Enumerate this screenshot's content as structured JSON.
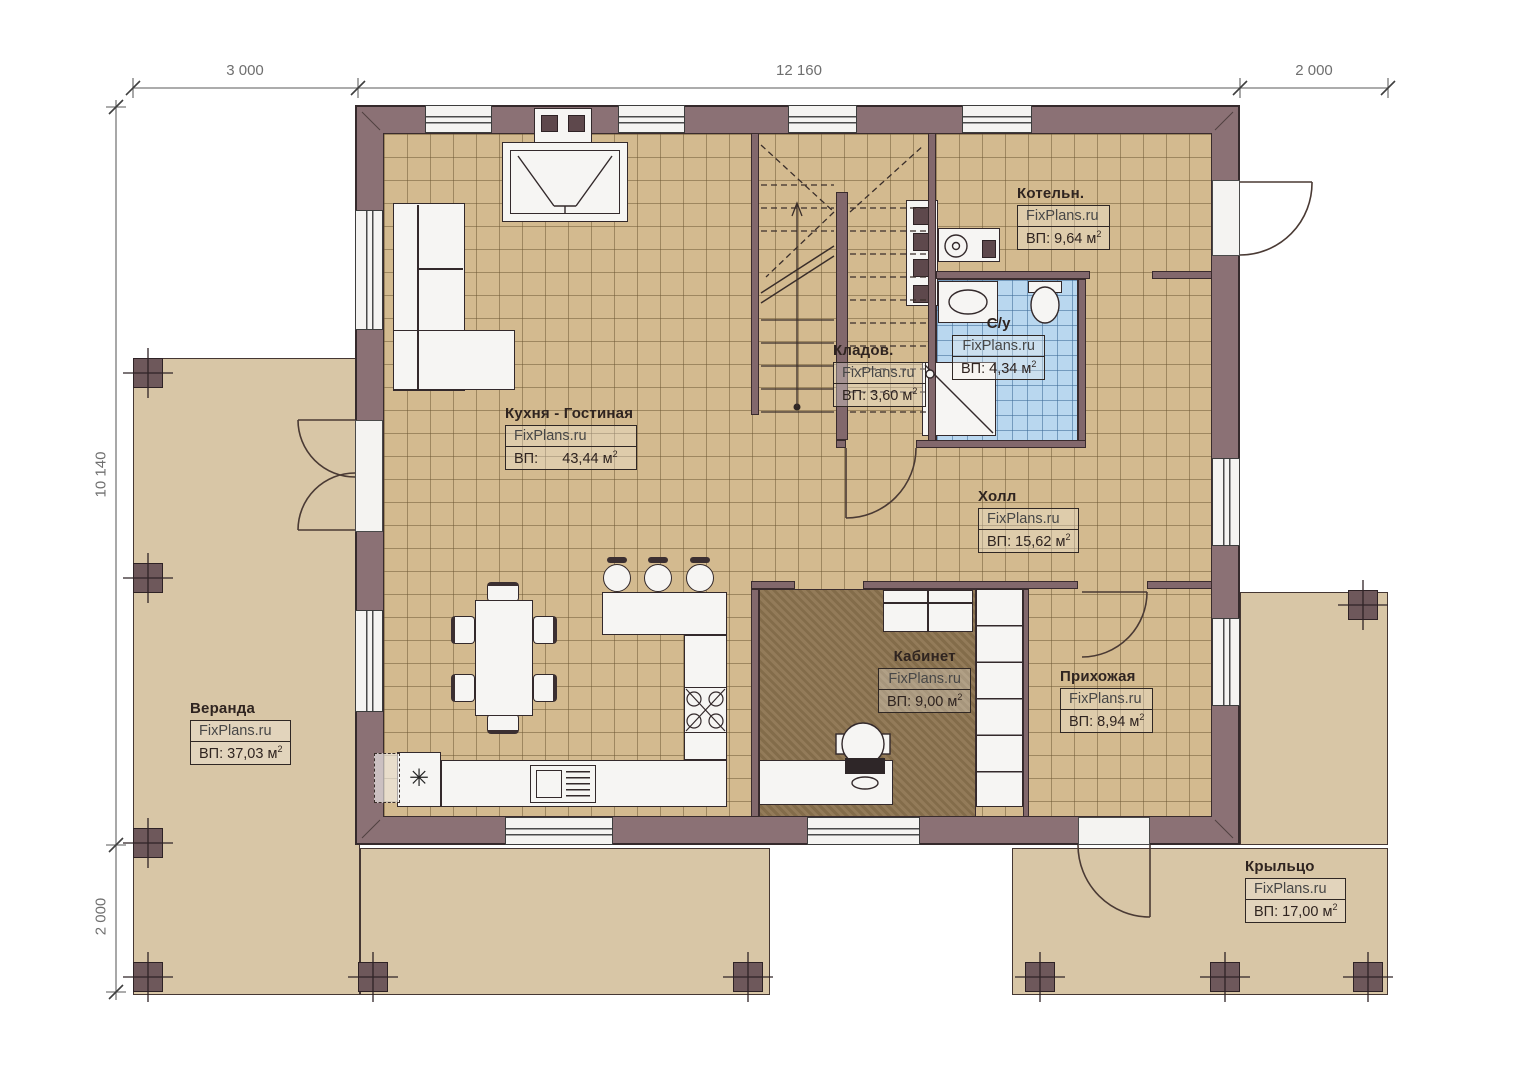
{
  "plan": {
    "watermark": "FixPlans.ru",
    "area_sup": "2",
    "dims": {
      "top": [
        "3 000",
        "12 160",
        "2 000"
      ],
      "left": [
        "10 140",
        "2 000"
      ]
    },
    "rooms": {
      "kitchen": {
        "name": "Кухня - Гостиная",
        "area": "ВП:      43,44 м"
      },
      "boiler": {
        "name": "Котельн.",
        "area": "ВП: 9,64 м"
      },
      "bath": {
        "name": "С/у",
        "area": "ВП: 4,34 м"
      },
      "storage": {
        "name": "Кладов.",
        "area": "ВП: 3,60 м"
      },
      "hall": {
        "name": "Холл",
        "area": "ВП: 15,62 м"
      },
      "office": {
        "name": "Кабинет",
        "area": "ВП: 9,00 м"
      },
      "entry": {
        "name": "Прихожая",
        "area": "ВП: 8,94 м"
      },
      "veranda": {
        "name": "Веранда",
        "area": "ВП: 37,03 м"
      },
      "porch": {
        "name": "Крыльцо",
        "area": "ВП: 17,00 м"
      }
    },
    "symbols": {
      "sink": "✳"
    },
    "colors": {
      "wall": "#8b7175",
      "floor_tile": "#d3ba8f",
      "veranda": "#d8c6a6",
      "bath_tile": "#b9d7ef",
      "office_floor": "#8d7450"
    }
  }
}
